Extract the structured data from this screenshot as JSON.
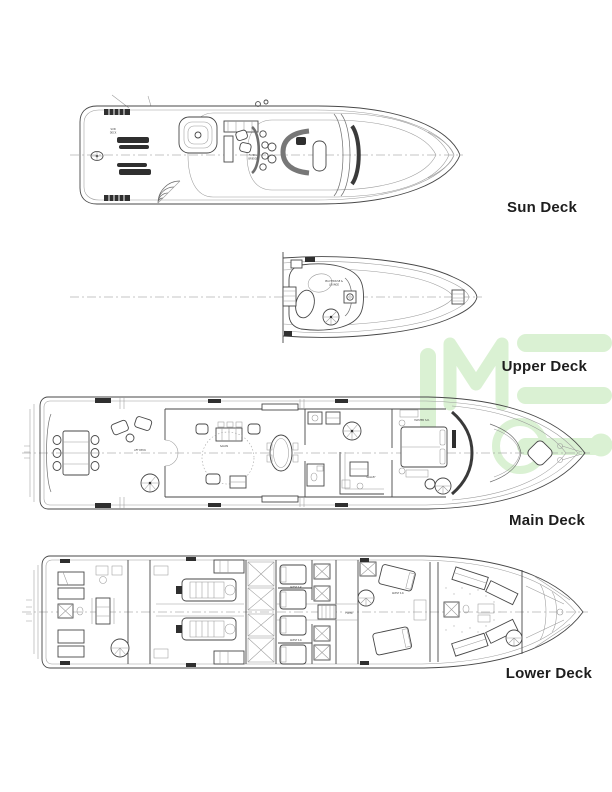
{
  "page": {
    "background": "#ffffff",
    "description": "Yacht general arrangement deck plans"
  },
  "watermark": {
    "logo_text": "IME",
    "color": "#d9f1d1"
  },
  "decks": [
    {
      "id": "sun",
      "label": "Sun Deck"
    },
    {
      "id": "upper",
      "label": "Upper Deck"
    },
    {
      "id": "main",
      "label": "Main Deck"
    },
    {
      "id": "lower",
      "label": "Lower Deck"
    }
  ],
  "plan_labels": {
    "sun_deck_1": "SUN",
    "sun_deck_2": "DECK",
    "flying_bridge_1": "FLYING",
    "flying_bridge_2": "BRIDGE",
    "pilothouse_1": "PILOTHOUSE &",
    "pilothouse_2": "LOUNGE",
    "aft_deck": "AFT DECK",
    "salon": "SALON",
    "galley": "GALLEY",
    "master_sr": "MASTER S.R.",
    "foyer": "FOYER",
    "guest_sr": "GUEST S.R."
  },
  "colors": {
    "line_main": "#474747",
    "line_light": "#9b9b9b",
    "accent_dark": "#2f2f2f",
    "watermark_green": "#d9f1d1"
  }
}
